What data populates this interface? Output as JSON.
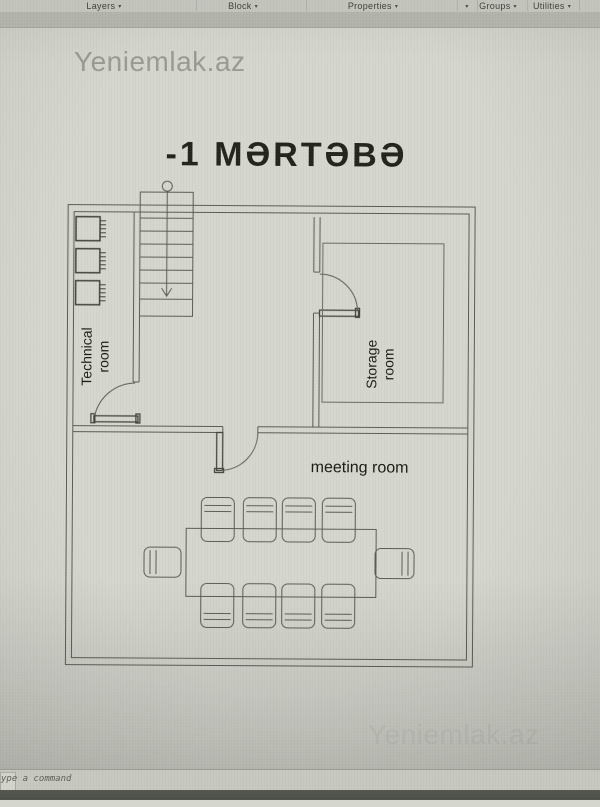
{
  "ribbon": {
    "panels": [
      {
        "label": "Layers"
      },
      {
        "label": "Block"
      },
      {
        "label": "Properties"
      },
      {
        "label": "Groups"
      },
      {
        "label": "Utilities"
      }
    ],
    "dropdown_glyph": "▾"
  },
  "watermarks": {
    "top_left": "Yeniemlak.az",
    "bottom_right": "Yeniemlak.az"
  },
  "drawing": {
    "title": "-1 MƏRTƏBƏ",
    "room_labels": {
      "technical": "Technical room",
      "storage": "Storage room",
      "meeting": "meeting room"
    }
  },
  "command_bar": {
    "prompt": "ype a command"
  },
  "colors": {
    "canvas": "#d5d7cf",
    "wall_line": "#5b5d55",
    "entity_line": "#43453d",
    "toolbar": "#c3c5bd",
    "bottom_strip": "#50524b",
    "watermark": "#9a9d95"
  }
}
